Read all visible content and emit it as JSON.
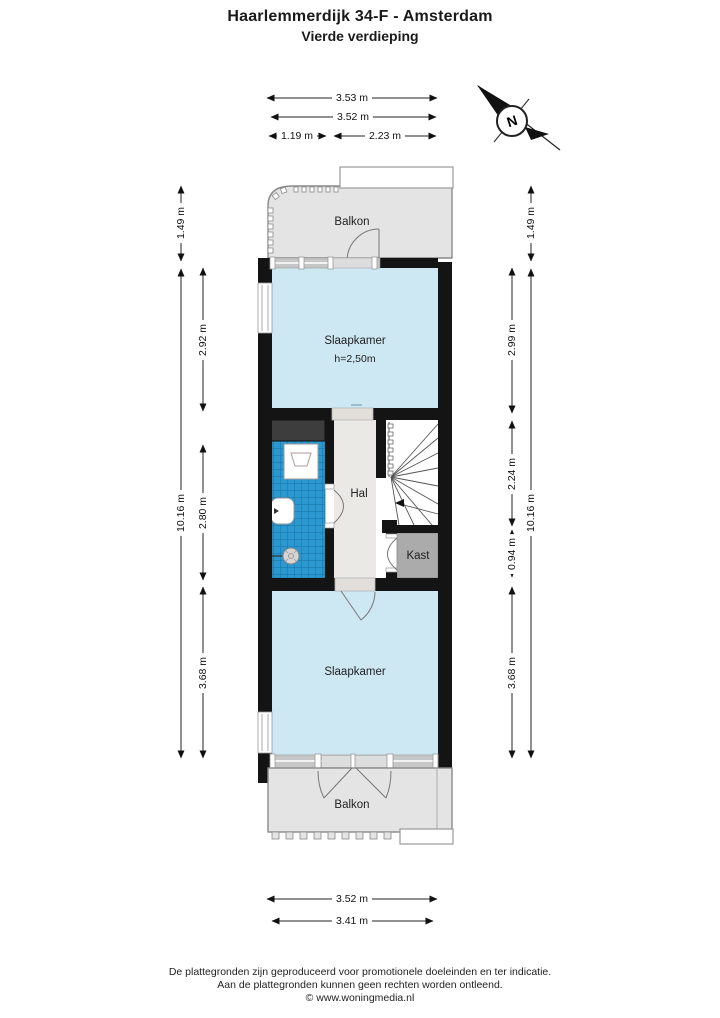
{
  "title": {
    "line1": "Haarlemmerdijk 34-F - Amsterdam",
    "line2": "Vierde verdieping"
  },
  "plan": {
    "rooms": {
      "balkon_top": {
        "label": "Balkon"
      },
      "slaapkamer_top": {
        "label": "Slaapkamer",
        "ceiling_height": "h=2,50m"
      },
      "hal": {
        "label": "Hal"
      },
      "kast": {
        "label": "Kast"
      },
      "slaapkamer_bottom": {
        "label": "Slaapkamer"
      },
      "balkon_bottom": {
        "label": "Balkon"
      }
    },
    "compass": {
      "north_label": "N"
    }
  },
  "dimensions": {
    "top": {
      "d1": "3.53 m",
      "d2": "3.52 m",
      "d3": "1.19 m",
      "d4": "2.23 m"
    },
    "bottom": {
      "d1": "3.52 m",
      "d2": "3.41 m"
    },
    "left": {
      "d1": "1.49 m",
      "d2": "2.92 m",
      "d3": "2.80 m",
      "d4": "3.68 m",
      "d5": "10.16 m"
    },
    "right": {
      "d1": "1.49 m",
      "d2": "2.99 m",
      "d3": "2.24 m",
      "d4": "0.94 m",
      "d5": "3.68 m",
      "d6": "10.16 m"
    }
  },
  "colors": {
    "wall": "#141414",
    "room_fill": "#cde7f3",
    "balcony_fill": "#e4e4e4",
    "hall_fill": "#eae9e5",
    "closet_fill": "#ababab",
    "shaft_fill": "#3d3d3d",
    "tile_fill": "#2b99cf",
    "tile_grid": "#1878ad",
    "frame_gray": "#c6c6c6",
    "line_gray": "#8a8a8a"
  },
  "footer": {
    "line1": "De plattegronden zijn geproduceerd voor promotionele doeleinden en ter indicatie.",
    "line2": "Aan de plattegronden kunnen geen rechten worden ontleend.",
    "line3": "© www.woningmedia.nl"
  }
}
